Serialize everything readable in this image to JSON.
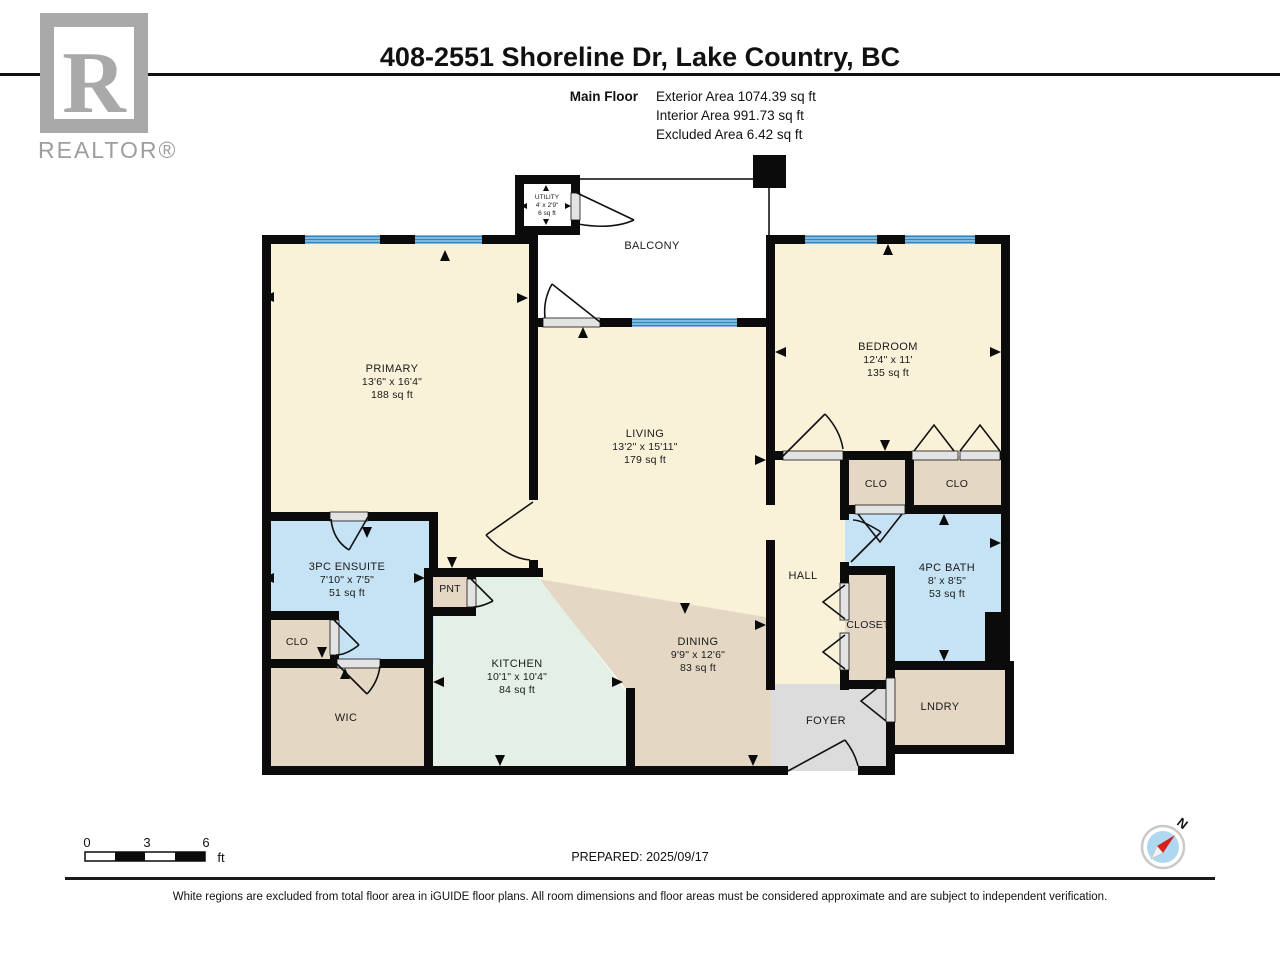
{
  "header": {
    "title": "408-2551 Shoreline Dr, Lake Country, BC",
    "floor_label": "Main Floor",
    "area_lines": [
      "Exterior Area 1074.39 sq ft",
      "Interior Area 991.73 sq ft",
      "Excluded Area 6.42 sq ft"
    ]
  },
  "logo": {
    "letter": "R",
    "brand": "REALTOR®"
  },
  "rooms": {
    "primary": {
      "name": "PRIMARY",
      "dim": "13'6\" x 16'4\"",
      "area": "188 sq ft"
    },
    "living": {
      "name": "LIVING",
      "dim": "13'2\" x 15'11\"",
      "area": "179 sq ft"
    },
    "bedroom": {
      "name": "BEDROOM",
      "dim": "12'4\" x 11'",
      "area": "135 sq ft"
    },
    "kitchen": {
      "name": "KITCHEN",
      "dim": "10'1\" x 10'4\"",
      "area": "84 sq ft"
    },
    "dining": {
      "name": "DINING",
      "dim": "9'9\" x 12'6\"",
      "area": "83 sq ft"
    },
    "ensuite": {
      "name": "3PC ENSUITE",
      "dim": "7'10\" x 7'5\"",
      "area": "51 sq ft"
    },
    "bath": {
      "name": "4PC BATH",
      "dim": "8' x 8'5\"",
      "area": "53 sq ft"
    },
    "utility": {
      "name": "UTILITY",
      "dim": "4' x 2'9\"",
      "area": "6 sq ft"
    },
    "balcony": {
      "name": "BALCONY"
    },
    "hall": {
      "name": "HALL"
    },
    "wic": {
      "name": "WIC"
    },
    "foyer": {
      "name": "FOYER"
    },
    "lndry": {
      "name": "LNDRY"
    },
    "closet": {
      "name": "CLOSET"
    },
    "pnt": {
      "name": "PNT"
    },
    "clo_ensuite": {
      "name": "CLO"
    },
    "clo_hall": {
      "name": "CLO"
    },
    "clo_bedroom": {
      "name": "CLO"
    }
  },
  "scale_bar": {
    "ticks": [
      "0",
      "3",
      "6"
    ],
    "unit": "ft"
  },
  "prepared": "PREPARED: 2025/09/17",
  "compass": {
    "north_label": "N"
  },
  "footer_note": "White regions are excluded from total floor area in iGUIDE floor plans. All room dimensions and floor areas must be considered approximate and are subject to independent verification.",
  "colors": {
    "room_cream": "#FAF1D9",
    "room_tan": "#E4D8C5",
    "room_blue": "#C6E3F5",
    "room_mint": "#E4F0E6",
    "room_gray": "#DCDCDC",
    "wall": "#0B0B0B",
    "window_blue": "#2E86C1"
  }
}
